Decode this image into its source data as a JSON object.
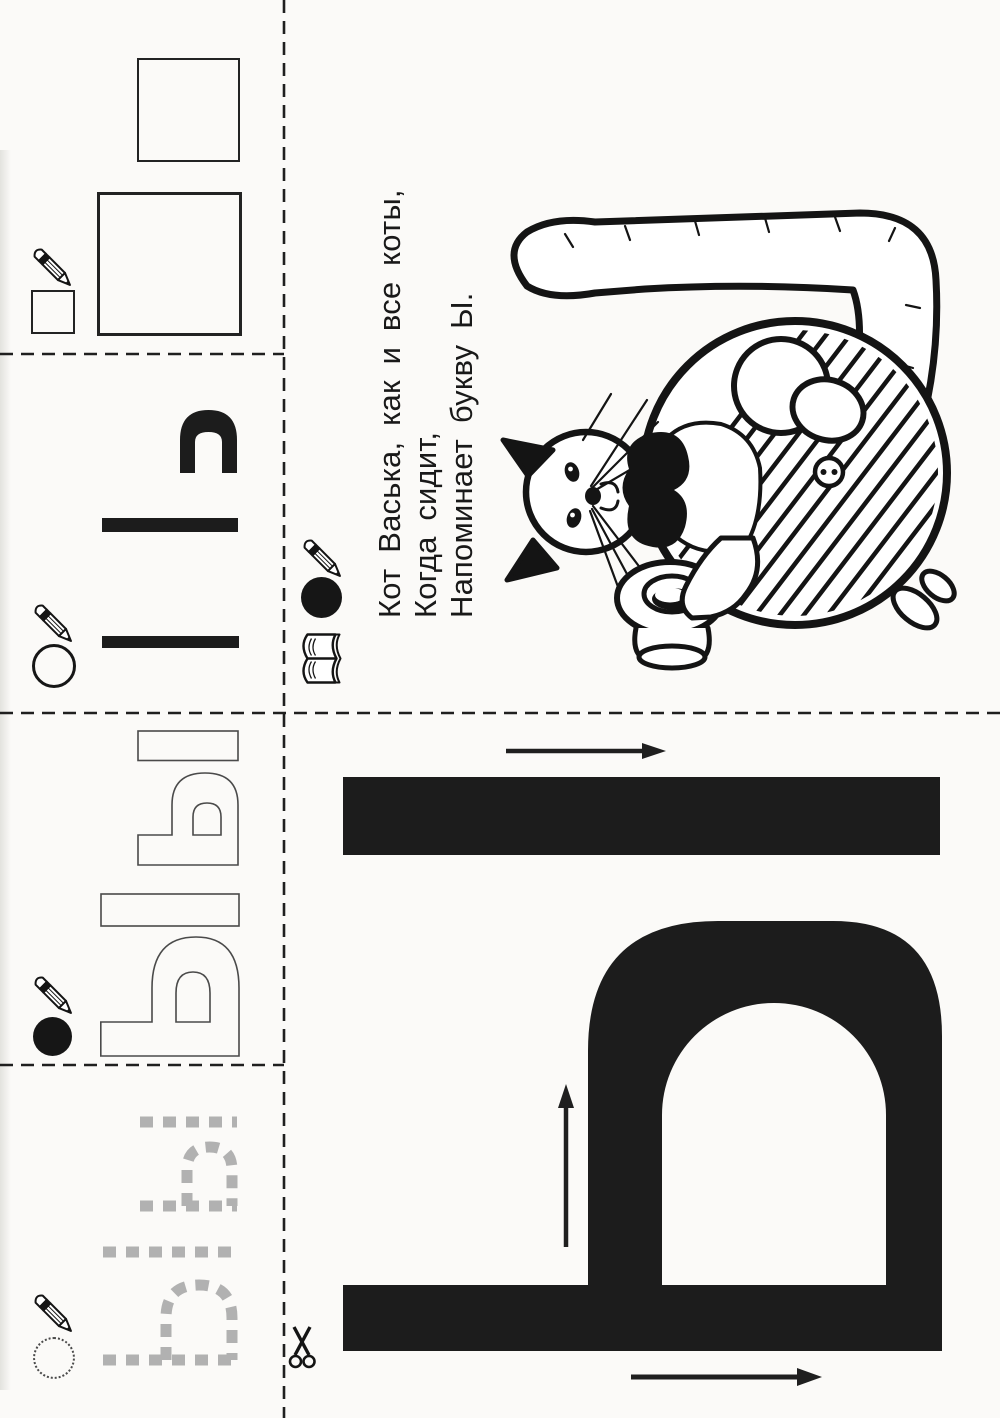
{
  "worksheet": {
    "letter": "Ы",
    "poem": {
      "line1": "Кот Васька, как и все коты,",
      "line2": "Когда сидит,",
      "line3": "Напоминает букву Ы."
    }
  },
  "colors": {
    "paper": "#fbfaf8",
    "ink": "#1c1c1c",
    "trace_gray": "#b1b1b1",
    "outline_stroke": "#4a4a4a"
  },
  "sections": {
    "copy_squares": {
      "icon": "pencil",
      "square_count": 3
    },
    "copy_strokes": {
      "icon": "pencil-and-circle",
      "element_count": 3
    },
    "outline_letters": {
      "icon": "pencil-and-filled-circle",
      "glyph": "Ы",
      "count": 2
    },
    "trace_letters": {
      "icon": "pencil-and-dotted-circle",
      "glyph": "Ы",
      "count": 2
    }
  },
  "legend": {
    "icons": [
      "pencil-icon",
      "filled-circle-icon",
      "book-icon"
    ]
  },
  "big_letter": {
    "glyph": "Ы",
    "stroke_arrow_count": 3
  },
  "cut_marks": {
    "icon": "scissors"
  }
}
